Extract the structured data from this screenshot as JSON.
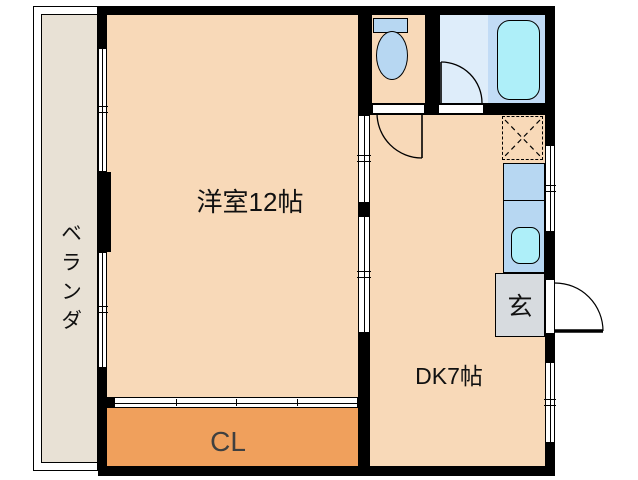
{
  "plan": {
    "type": "apartment-floor-plan",
    "rooms": {
      "western_room": {
        "label": "洋室12帖"
      },
      "dining_kitchen": {
        "label": "DK7帖"
      },
      "closet": {
        "label": "CL"
      },
      "entrance": {
        "label": "玄"
      },
      "balcony": {
        "label": "ベランダ"
      }
    },
    "fixtures": {
      "toilet": "toilet-fixture",
      "bathtub": "bathtub-fixture",
      "kitchen_sink": "kitchen-sink-fixture",
      "kitchen_counter": "kitchen-counter",
      "refrigerator_space": "refrigerator-space-dashed",
      "doors": [
        "wc-swing-door",
        "bath-swing-door",
        "entry-swing-door"
      ],
      "windows": [
        "balcony-window-upper",
        "balcony-window-lower",
        "kitchen-window",
        "dk-window"
      ],
      "sliding_partitions": [
        "room-dk-partition-upper",
        "room-dk-partition-lower",
        "closet-sliding-door"
      ]
    },
    "colors": {
      "wall": "#000000",
      "room_floor": "#F8D9B8",
      "closet_floor": "#F0A05C",
      "balcony_floor": "#E8E1D5",
      "entrance_floor": "#D7DBDF",
      "bathroom_floor": "#DEEDFA",
      "bathtub_area": "#C2DCF6",
      "water_cyan": "#AEEFF9",
      "fixture_blue": "#B7D7F2",
      "label_text": "#111111",
      "closet_label_text": "#404040"
    }
  }
}
